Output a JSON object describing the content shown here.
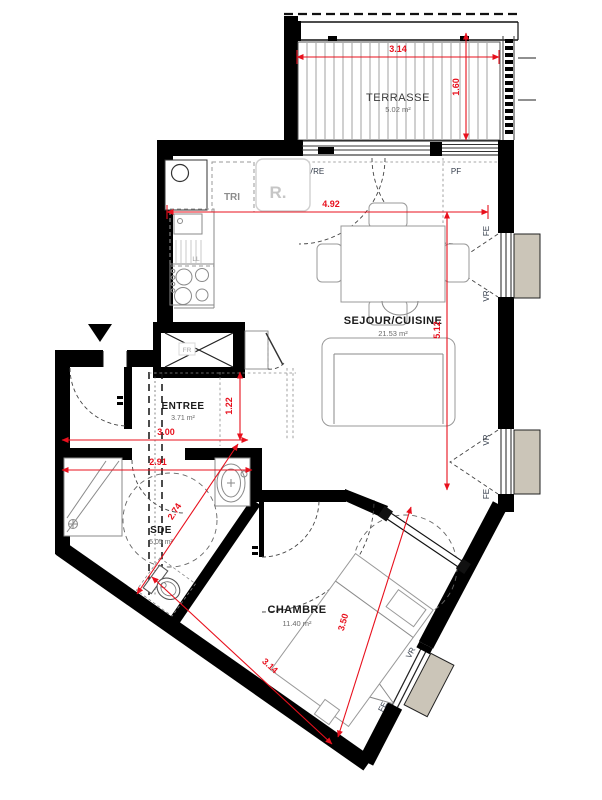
{
  "rooms": {
    "terrasse": {
      "name": "TERRASSE",
      "area": "5.02 m²"
    },
    "sejour": {
      "name": "SEJOUR/CUISINE",
      "area": "21.53 m²"
    },
    "entree": {
      "name": "ENTREE",
      "area": "3.71 m²"
    },
    "sde": {
      "name": "SDE",
      "area": "5.05 m²"
    },
    "chambre": {
      "name": "CHAMBRE",
      "area": "11.40 m²"
    }
  },
  "dimensions": {
    "terrasse_width": "3.14",
    "terrasse_depth": "1.60",
    "sejour_width": "4.92",
    "sejour_depth": "5.12",
    "entree_depth": "1.22",
    "entree_width": "3.00",
    "sde_width": "2.91",
    "sde_diagonal": "2.74",
    "chambre_depth": "3.50",
    "chambre_width": "3.14"
  },
  "openings": {
    "sliding_bay": "VRE",
    "fixed_window": "PF",
    "window": "FE",
    "roller_shutter": "VR"
  },
  "equipment": {
    "waste": "TRI",
    "fridge_slot": "R.",
    "washing_machine": "LL",
    "fridge": "FR"
  },
  "colors": {
    "wall": "#000000",
    "dimension": "#e8101d",
    "shutter_box": "#cbc5b8",
    "furniture_line": "#999999"
  }
}
